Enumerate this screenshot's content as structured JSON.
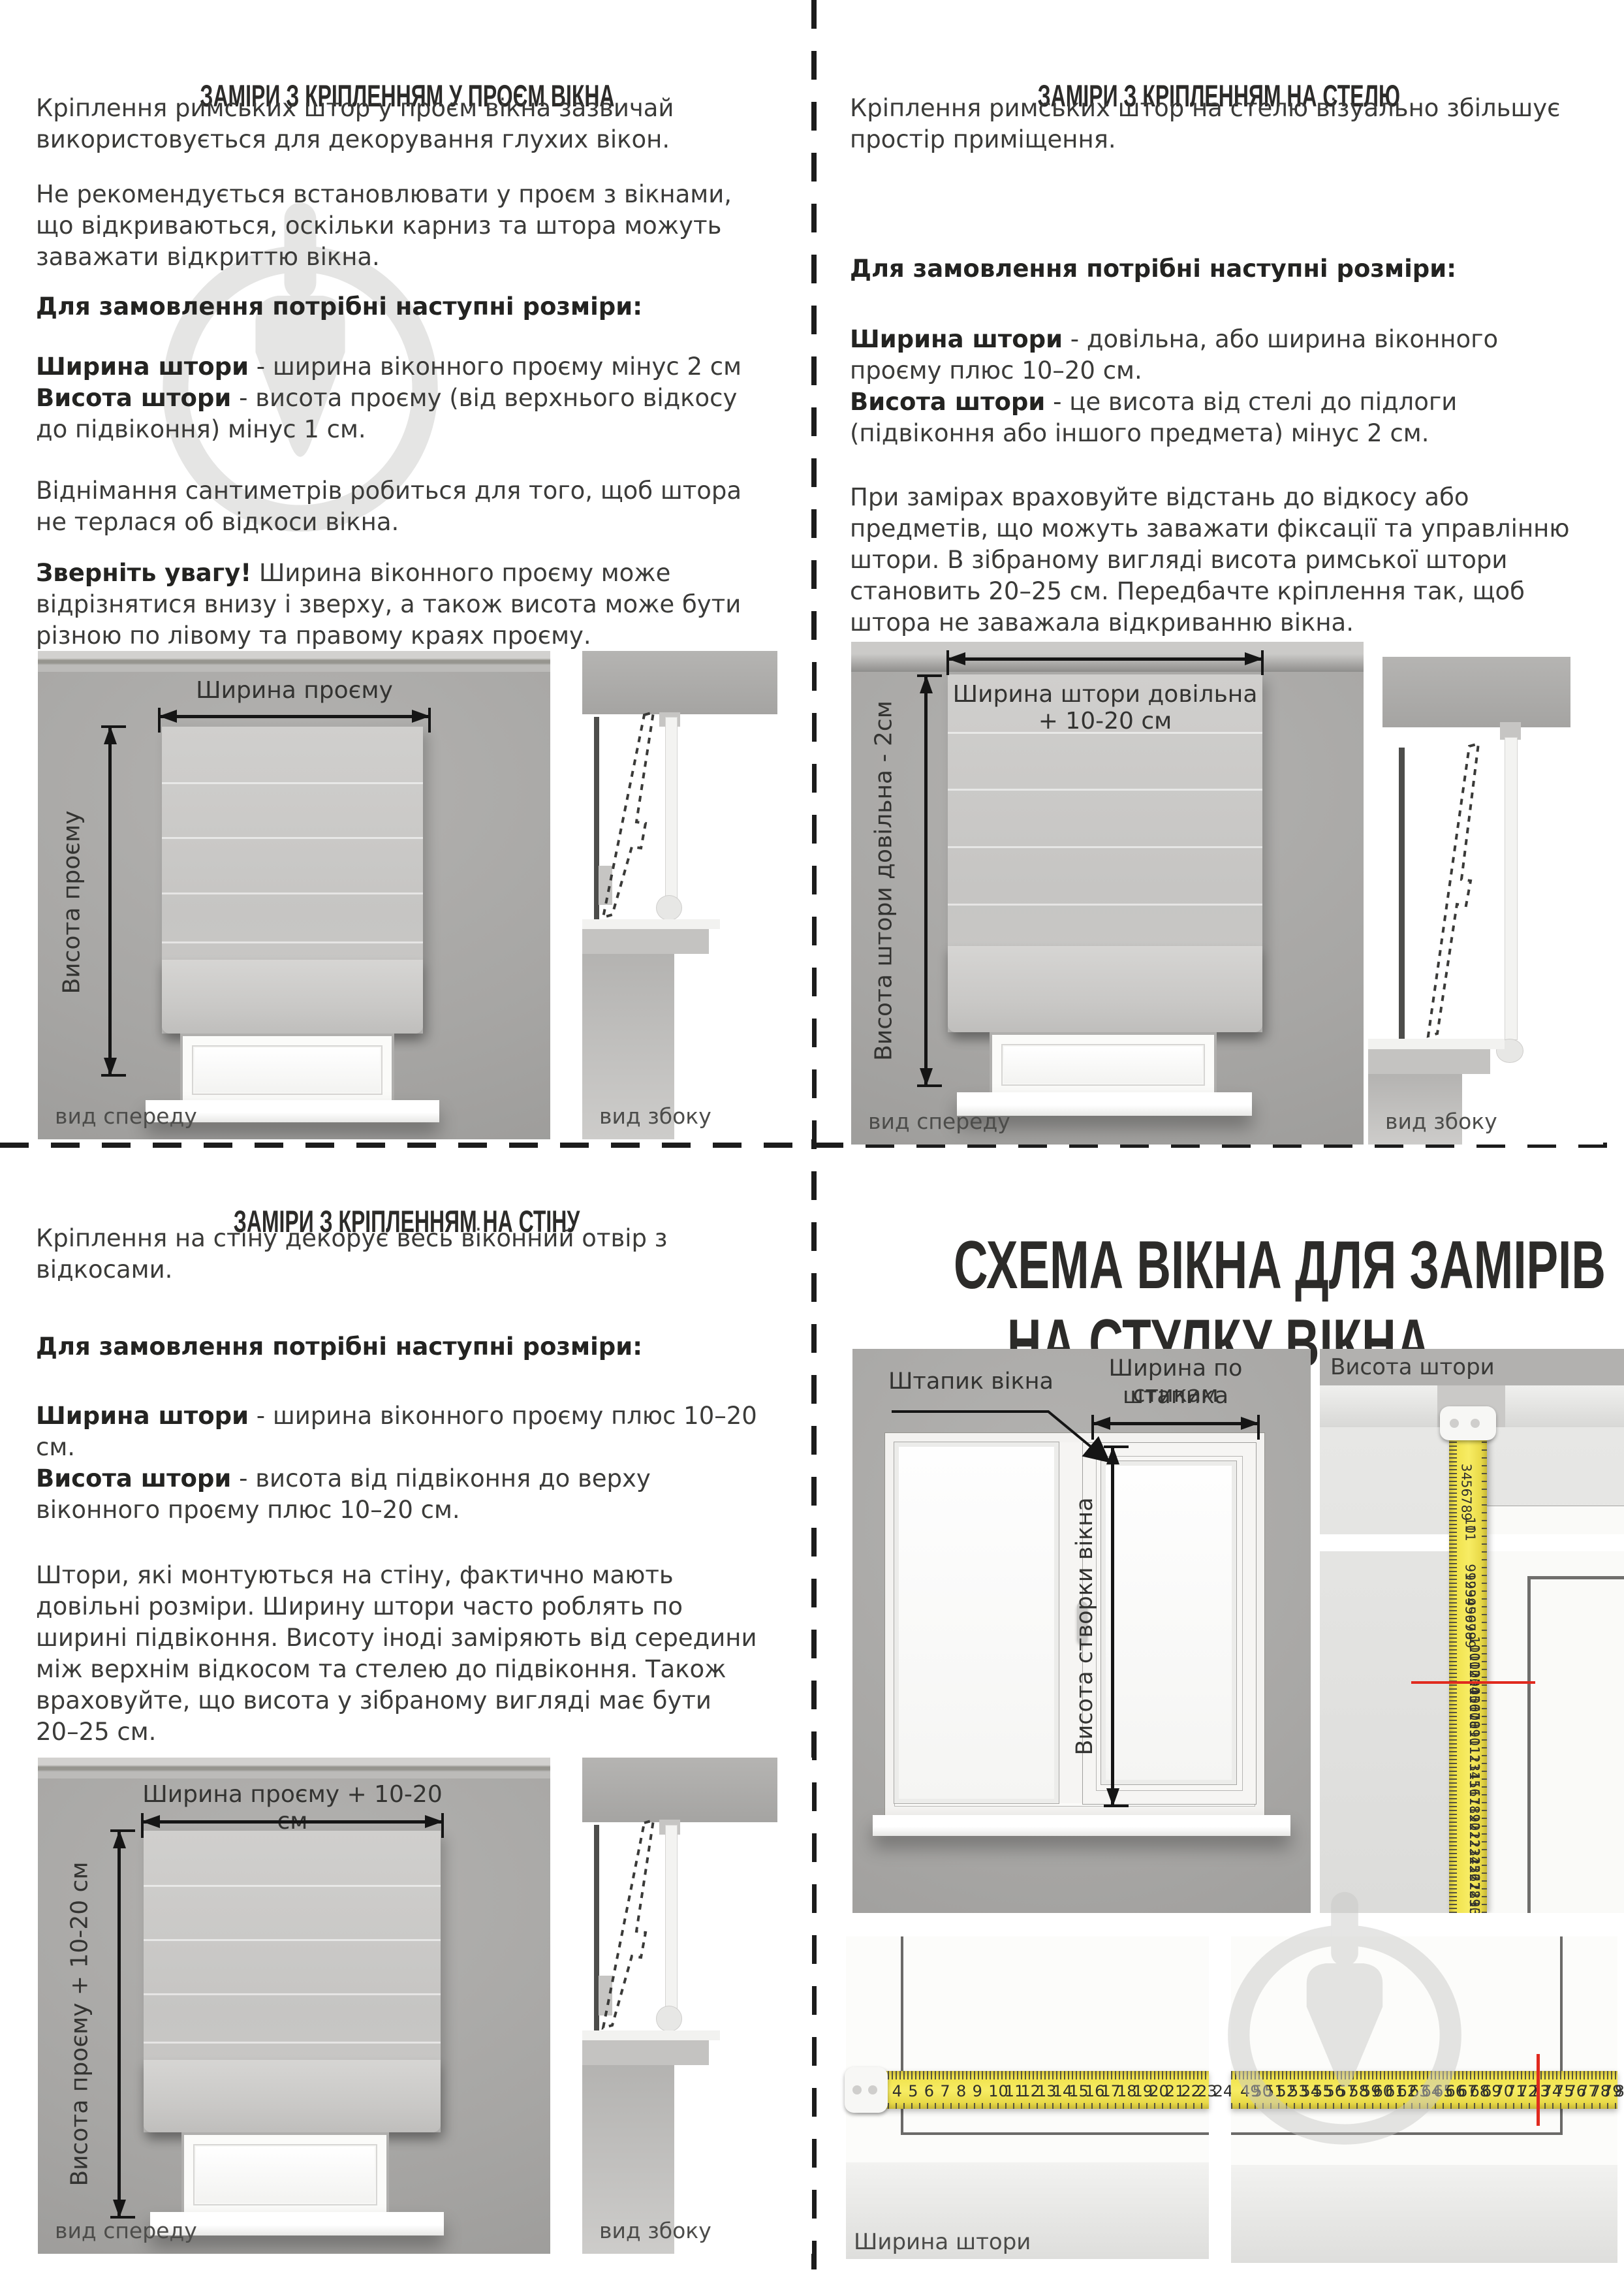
{
  "q1": {
    "title": "ЗАМІРИ З КРІПЛЕННЯМ У ПРОЄМ ВІКНА",
    "p1": "Кріплення римських штор у проєм вікна зазвичай використовується для декорування глухих вікон.",
    "p2": "Не рекомендується встановлювати у проєм з вікнами, що відкриваються, оскільки карниз та штора можуть заважати відкриттю вікна.",
    "order_heading": "Для замовлення потрібні наступні розміри:",
    "size1_term": "Ширина штори",
    "size1_rest": " - ширина віконного проєму мінус 2 см",
    "size2_term": "Висота штори",
    "size2_rest": " - висота проєму (від верхнього відкосу до підвіконня) мінус 1 см.",
    "p3": "Віднімання сантиметрів робиться для того, щоб штора не терлася об відкоси вікна.",
    "note_lead": "Зверніть увагу!",
    "note_rest": " Ширина віконного проєму може відрізнятися внизу і зверху, а також висота може бути різною по лівому та правому краях проєму.",
    "diagram": {
      "width_label": "Ширина проєму",
      "height_label": "Висота проєму",
      "front_caption": "вид спереду",
      "side_caption": "вид збоку"
    }
  },
  "q2": {
    "title": "ЗАМІРИ З КРІПЛЕННЯМ НА СТЕЛЮ",
    "p1": "Кріплення римських штор на стелю візуально збільшує простір приміщення.",
    "order_heading": "Для замовлення потрібні наступні розміри:",
    "size1_term": "Ширина штори",
    "size1_rest": " - довільна, або ширина віконного проєму плюс 10–20 см.",
    "size2_term": "Висота штори",
    "size2_rest": " - це висота від стелі до підлоги (підвіконня або іншого предмета) мінус 2 см.",
    "p3": "При замірах враховуйте відстань до відкосу або предметів, що можуть заважати фіксації та управлінню штори. В зібраному вигляді висота римської штори становить 20–25 см. Передбачте кріплення так, щоб штора не заважала відкриванню вікна.",
    "diagram": {
      "width_label": "Ширина штори довільна + 10-20 см",
      "height_label": "Висота штори довільна - 2см",
      "front_caption": "вид спереду",
      "side_caption": "вид збоку"
    }
  },
  "q3": {
    "title": "ЗАМІРИ З КРІПЛЕННЯМ НА СТІНУ",
    "p1": "Кріплення на стіну декорує весь віконний отвір з відкосами.",
    "order_heading": "Для замовлення потрібні наступні розміри:",
    "size1_term": "Ширина штори",
    "size1_rest": " - ширина віконного проєму плюс 10–20 см.",
    "size2_term": "Висота штори",
    "size2_rest": " - висота від підвіконня до верху віконного проєму плюс 10–20 см.",
    "p3": "Штори, які монтуються на стіну, фактично мають довільні розміри. Ширину штори часто роблять по ширині підвіконня. Висоту іноді заміряють від середини між верхнім відкосом та стелею до підвіконня. Також враховуйте, що висота у зібраному вигляді має бути 20–25 см.",
    "diagram": {
      "width_label": "Ширина проєму + 10-20 см",
      "height_label": "Висота проєму + 10-20 см",
      "front_caption": "вид спереду",
      "side_caption": "вид збоку"
    }
  },
  "q4": {
    "title_line1": "СХЕМА ВІКНА ДЛЯ ЗАМІРІВ",
    "title_line2": "НА СТУЛКУ ВІКНА",
    "labels": {
      "bead": "Штапик вікна",
      "width_by_bead_l1": "Ширина по стикам",
      "width_by_bead_l2": "штапика",
      "sash_height": "Висота створки вікна",
      "curtain_height": "Висота штори",
      "curtain_width": "Ширина штори"
    },
    "tape_vertical_top": [
      3,
      4,
      5,
      6,
      7,
      8,
      9,
      10,
      11
    ],
    "tape_vertical_bottom": [
      91,
      92,
      93,
      94,
      95,
      96,
      97,
      98,
      99,
      100,
      101,
      102,
      103,
      104,
      105,
      106,
      107,
      108,
      109,
      110,
      111,
      112,
      113,
      114,
      115,
      116,
      117,
      118,
      119,
      120,
      121,
      122,
      123,
      124,
      125,
      126,
      127,
      128,
      129,
      130,
      131
    ],
    "tape_vertical_red_at": 104,
    "tape_h_left": [
      3,
      4,
      5,
      6,
      7,
      8,
      9,
      10,
      11,
      12,
      13,
      14,
      15,
      16,
      17,
      18,
      19,
      20,
      21,
      22,
      23,
      24
    ],
    "tape_h_right": [
      49,
      50,
      51,
      52,
      53,
      54,
      55,
      56,
      57,
      58,
      59,
      60,
      61,
      62,
      63,
      64,
      65,
      66,
      67,
      68,
      69,
      70,
      71,
      72,
      73,
      74,
      75,
      76,
      77,
      78,
      79,
      80
    ],
    "tape_h_red_at": 73,
    "colors": {
      "tape_yellow": "#f0e24c",
      "red_mark": "#e02a1e",
      "watermark_gray": "#d0d0ce"
    }
  }
}
